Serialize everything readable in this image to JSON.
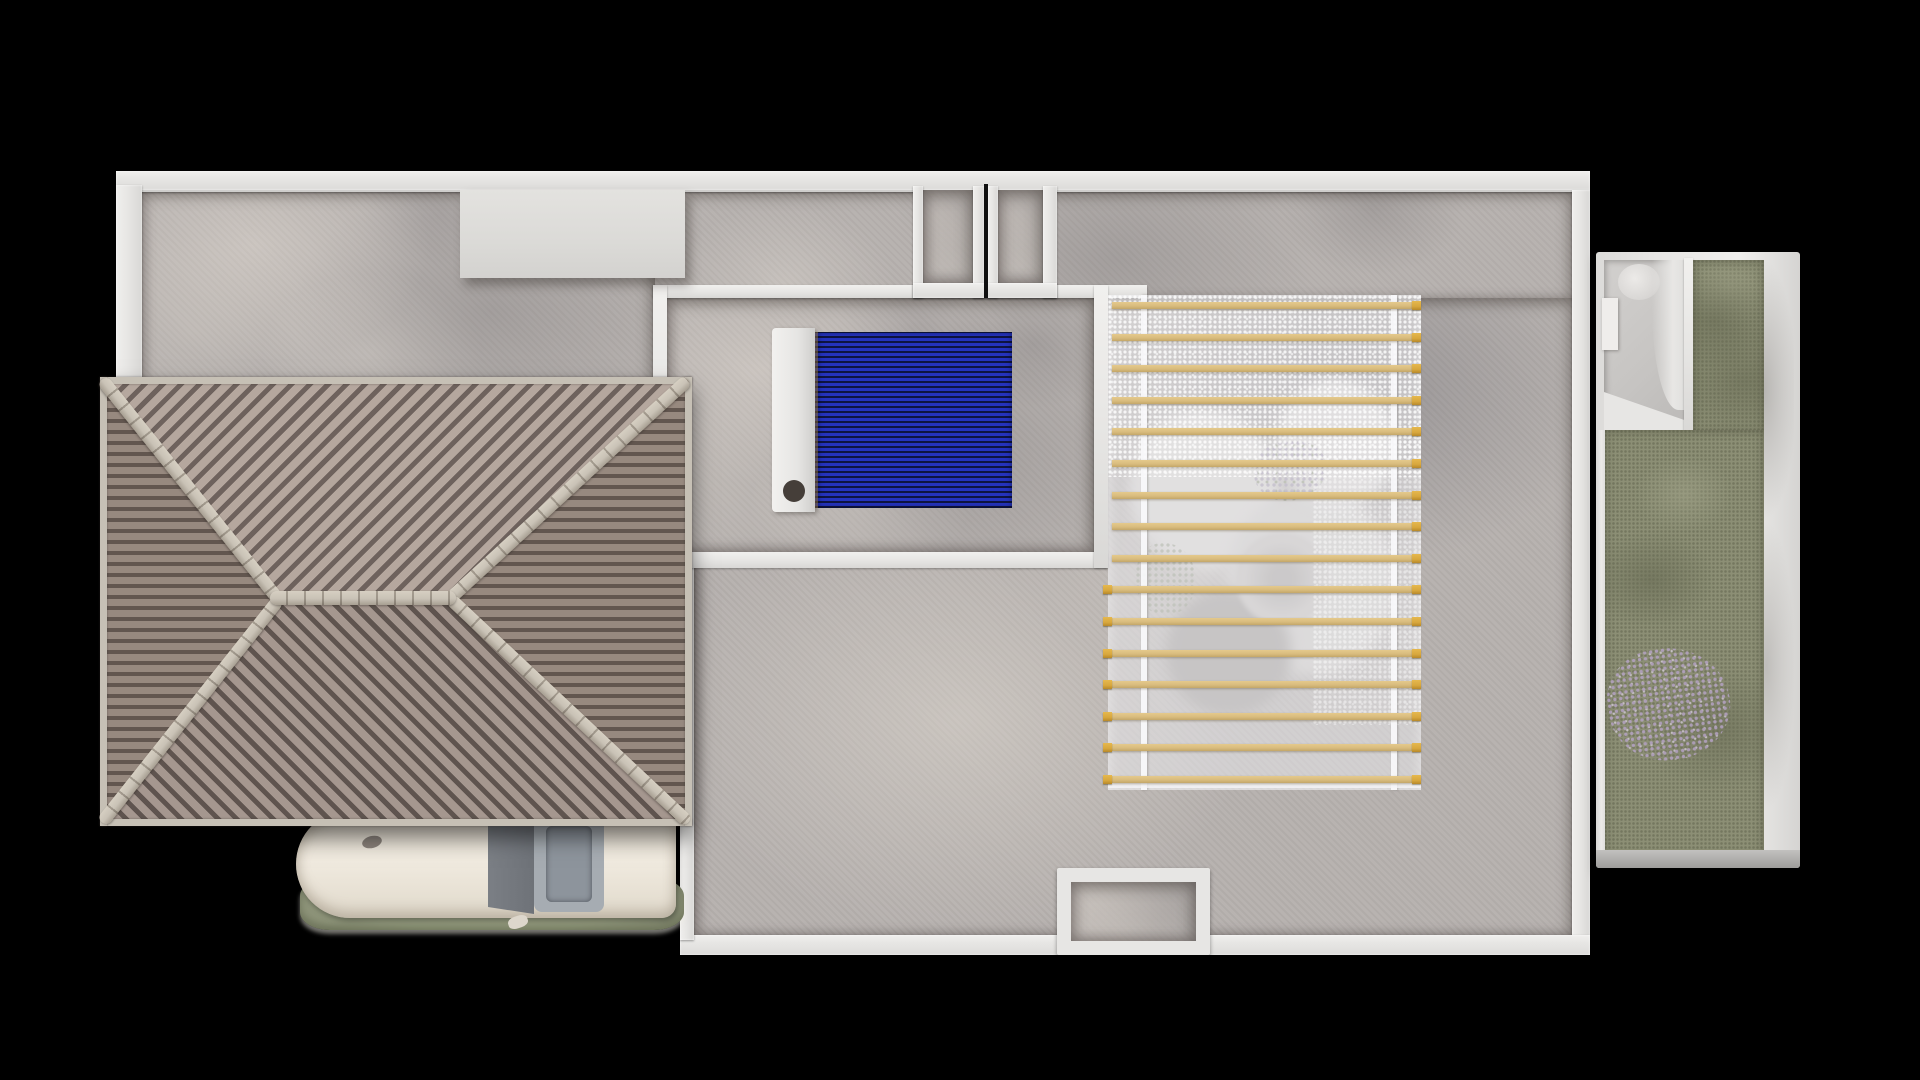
{
  "scene": {
    "type": "3d-architectural-top-view",
    "subject": "house roof-terrace plan with hip roof, solar collector, glass pergola, carport and garden annex",
    "background": "#000000"
  },
  "colors": {
    "black": "#000000",
    "wall": "#e7e6e4",
    "wallEdge": "#c9c8c6",
    "floor": "#b6b1ae",
    "roofNorthLight": "#b5a79e",
    "roofNorthDark": "#6e625d",
    "roofSouthLight": "#a5978f",
    "roofSouthDark": "#5f544f",
    "roofSideLight": "#97897f",
    "roofSideDark": "#62564f",
    "roofCap": "#c9c2b6",
    "roofEave": "#c6c0b5",
    "solarTube": "#2433bd",
    "solarTubeDark": "#0e1442",
    "solarPort": "#453e39",
    "pergolaSlat": "#d9bc7e",
    "pergolaSlatCap": "#d8a73d",
    "glass": "rgba(233,234,237,0.52)",
    "grass": "#99a083",
    "garden": "#8c8f75",
    "flowers": "#b5a3c4",
    "carBody": "#f0eadf",
    "carGlass": "#6e7278",
    "carRoof": "#a6acb2"
  },
  "roof": {
    "type": "hip",
    "ridge_orientation": "horizontal",
    "tile_style": "barrel-tiles",
    "faces": [
      "north",
      "south",
      "west",
      "east"
    ]
  },
  "pergola": {
    "slat_count": 16,
    "first_y_px": 7,
    "spacing_px": 31.6,
    "slat_height_px": 7,
    "slat_left_px": 4,
    "slat_length_px": 300,
    "cap_size_px": 9,
    "left_cap_from_index": 9,
    "cover": "glass with sun glare"
  },
  "solar_collector": {
    "orientation": "horizontal tubes",
    "tube_stripe_period_px": 5,
    "manifold_side": "left",
    "port": "round fitting lower-left"
  },
  "annex": {
    "kind": "walled garden courtyard with small bathroom",
    "has_flowers": true
  },
  "car": {
    "color": "cream-white",
    "parked_under": "roof overhang carport"
  }
}
